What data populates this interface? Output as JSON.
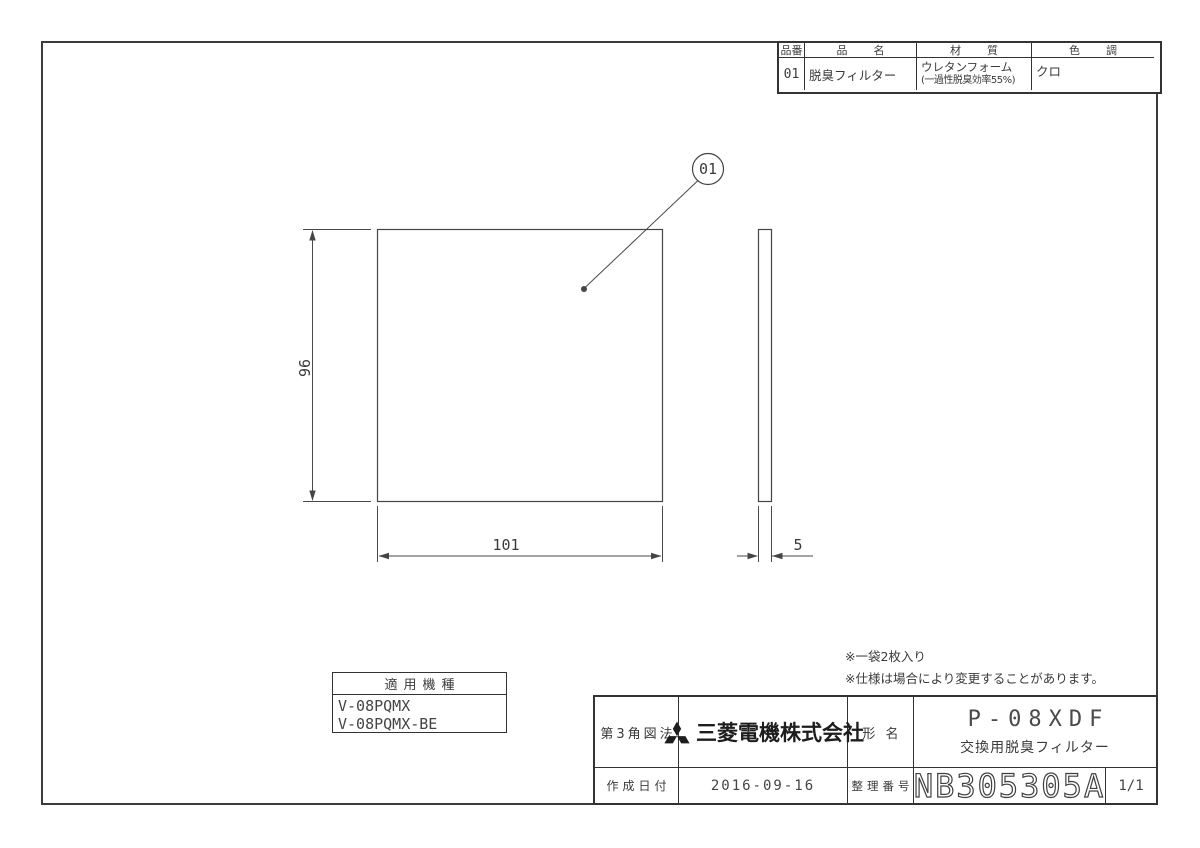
{
  "parts_table": {
    "headers": {
      "part_no": "品番",
      "part_name": "品名",
      "material": "材質",
      "color": "色調"
    },
    "row": {
      "part_no": "01",
      "part_name": "脱臭フィルター",
      "material_line1": "ウレタンフォーム",
      "material_line2": "(一過性脱臭効率55%)",
      "color": "クロ"
    }
  },
  "drawing": {
    "balloon_label": "01",
    "dim_height": "96",
    "dim_width": "101",
    "dim_thickness": "5"
  },
  "notes": {
    "line1": "※一袋2枚入り",
    "line2": "※仕様は場合により変更することがあります。"
  },
  "applicable_models": {
    "title": "適用機種",
    "models": [
      "V-08PQMX",
      "V-08PQMX-BE"
    ]
  },
  "title_block": {
    "projection_label": "第3角図法",
    "company": "三菱電機株式会社",
    "model_label": "形 名",
    "model_value": "P-08XDF",
    "product_name": "交換用脱臭フィルター",
    "date_label": "作成日付",
    "date_value": "2016-09-16",
    "ref_label": "整理番号",
    "ref_value": "NB305305A",
    "sheet": "1/1"
  },
  "colors": {
    "line": "#3f3f3f",
    "text": "#3a3a3a",
    "background": "#ffffff"
  }
}
